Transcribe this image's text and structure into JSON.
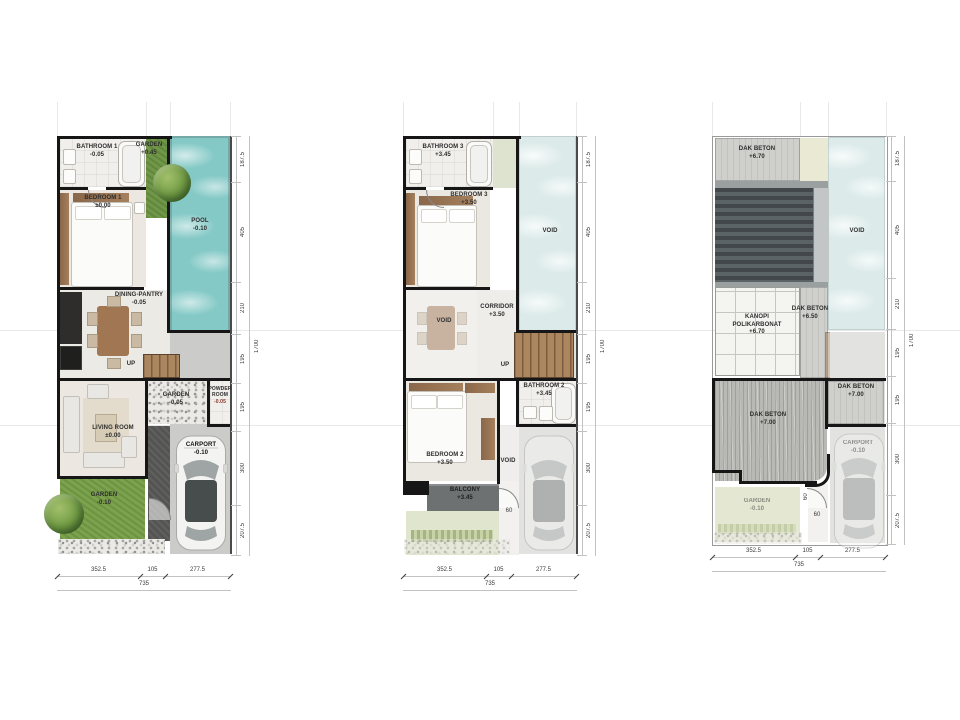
{
  "dims": {
    "vertical": [
      "187.5",
      "405",
      "210",
      "195",
      "195",
      "300",
      "207.5"
    ],
    "vertical_total": "1700",
    "horizontal": [
      "352.5",
      "105",
      "277.5"
    ],
    "horizontal_total": "735",
    "entry_width": "60"
  },
  "palette": {
    "pool": "#84c9c6",
    "pool_faded": "#dcebea",
    "grass": "#7ba24c",
    "wall": "#161616",
    "concrete": "#cfcfcc",
    "roof_dark": "#41474a",
    "wood": "#9b7a57",
    "balcony": "#6e7172"
  },
  "plans": [
    {
      "title": "ground-floor",
      "rooms": {
        "bathroom1": {
          "name": "BATHROOM 1",
          "level": "-0.05"
        },
        "garden_top": {
          "name": "GARDEN",
          "level": "+0.45"
        },
        "pool": {
          "name": "POOL",
          "level": "-0.10"
        },
        "bedroom1": {
          "name": "BEDROOM 1",
          "level": "±0.00"
        },
        "dining": {
          "name": "DINING-PANTRY",
          "level": "-0.05"
        },
        "up": {
          "name": "UP"
        },
        "garden_mid": {
          "name": "GARDEN",
          "level": "-0.05"
        },
        "powder": {
          "name": "POWDER ROOM",
          "level": "-0.05"
        },
        "living": {
          "name": "LIVING ROOM",
          "level": "±0.00"
        },
        "carport": {
          "name": "CARPORT",
          "level": "-0.10"
        },
        "garden_bottom": {
          "name": "GARDEN",
          "level": "-0.10"
        }
      }
    },
    {
      "title": "upper-floor",
      "rooms": {
        "bathroom3": {
          "name": "BATHROOM 3",
          "level": "+3.45"
        },
        "bedroom3": {
          "name": "BEDROOM 3",
          "level": "+3.50"
        },
        "void_right": {
          "name": "VOID"
        },
        "corridor": {
          "name": "CORRIDOR",
          "level": "+3.50"
        },
        "void_left": {
          "name": "VOID"
        },
        "up": {
          "name": "UP"
        },
        "bathroom2": {
          "name": "BATHROOM 2",
          "level": "+3.45"
        },
        "bedroom2": {
          "name": "BEDROOM 2",
          "level": "+3.50"
        },
        "void_small": {
          "name": "VOID"
        },
        "balcony": {
          "name": "BALCONY",
          "level": "+3.45"
        }
      }
    },
    {
      "title": "roof-plan",
      "rooms": {
        "dak_top": {
          "name": "DAK BETON",
          "level": "+6.70"
        },
        "void_right": {
          "name": "VOID"
        },
        "dak_mid": {
          "name": "DAK BETON",
          "level": "+6.50"
        },
        "kanopi": {
          "name": "KANOPI POLIKARBONAT",
          "level": "+6.70"
        },
        "dak_right": {
          "name": "DAK BETON",
          "level": "+7.00"
        },
        "dak_left": {
          "name": "DAK BETON",
          "level": "+7.00"
        },
        "garden_bottom": {
          "name": "GARDEN",
          "level": "-0.10"
        },
        "carport": {
          "name": "CARPORT",
          "level": "-0.10"
        }
      }
    }
  ]
}
